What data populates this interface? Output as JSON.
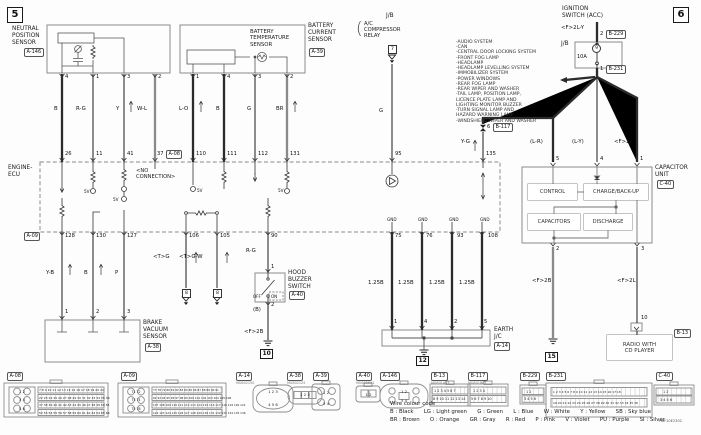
{
  "page": {
    "ref_left": "5",
    "ref_right": "6",
    "doc_code": "H8F10E230C"
  },
  "top": {
    "nps": {
      "name": "NEUTRAL\nPOSITION\nSENSOR",
      "conn": "A-146",
      "pins": [
        "4",
        "1",
        "3",
        "2"
      ],
      "wires": [
        "B",
        "R-G",
        "Y",
        "W-L"
      ]
    },
    "bcs": {
      "name": "BATTERY\nCURRENT\nSENSOR",
      "inner": "BATTERY\nTEMPERATURE\nSENSOR",
      "conn": "A-39",
      "pins": [
        "1",
        "4",
        "3",
        "2"
      ],
      "wires": [
        "L-O",
        "B",
        "G",
        "BR"
      ]
    },
    "relay": {
      "jb": "J/B",
      "brace": "(",
      "name": "A/C\nCOMPRESSOR\nRELAY",
      "ref": "7",
      "wire": "G"
    },
    "ign": {
      "name": "IGNITION\nSWITCH (ACC)",
      "wire": "<F>2L-Y",
      "pin2": "2",
      "conn2": "B-229",
      "jb": "J/B",
      "fuse": "9",
      "amp": "10A",
      "pin1": "1",
      "conn1": "B-231"
    },
    "systems": [
      "-AUDIO SYSTEM",
      "-CAN",
      "-CENTRAL DOOR LOCKING SYSTEM",
      "-FRONT FOG LAMP",
      "-HEADLAMP",
      "-HEADLAMP LEVELLING SYSTEM",
      "-IMMOBILIZER SYSTEM",
      "-POWER WINDOWS",
      "-REAR FOG LAMP",
      "-REAR WIPER AND WASHER",
      "-TAIL LAMP, POSITION LAMP,",
      "  LICENCE PLATE LAMP AND",
      "  LIGHTING MONITOR BUZZER",
      "-TURN SIGNAL LAMP AND",
      "  HAZARD WARNING LAMP",
      "-WINDSHIELD WIPER AND WASHER"
    ],
    "feed": {
      "yg": "Y-G",
      "pin6": "6",
      "conn": "B-117",
      "lr": "(L-R)",
      "ly": "(L-Y)",
      "f2l": "<F>2L"
    }
  },
  "ecu": {
    "name": "ENGINE-\nECU",
    "a08": "A-08",
    "a09": "A-09",
    "noconn": "<NO\nCONNECTION>",
    "v5": "5V",
    "gnd": "GND",
    "top_pins": [
      "26",
      "11",
      "41",
      "37",
      "110",
      "111",
      "112",
      "131",
      "95",
      "135"
    ],
    "bot_pins": [
      "128",
      "130",
      "127",
      "106",
      "105",
      "90",
      "75",
      "76",
      "93",
      "108"
    ]
  },
  "bottom": {
    "brake": {
      "wires": [
        "Y-B",
        "B",
        "P"
      ],
      "pins": [
        "1",
        "2",
        "3"
      ],
      "name": "BRAKE\nVACUUM\nSENSOR",
      "conn": "A-38"
    },
    "shield": {
      "wires": [
        "<T>G",
        "<T>G-W"
      ],
      "refs": [
        "8",
        "8"
      ]
    },
    "hood": {
      "wire": "R-G",
      "pin1": "1",
      "name": "HOOD\nBUZZER\nSWITCH",
      "conn": "A-40",
      "off": "OFF",
      "on": "ON",
      "pin2": "2",
      "wb": "(B)",
      "f2b": "<F>2B",
      "gnd_ref": "10"
    },
    "earth": {
      "wires": [
        "1.25B",
        "1.25B",
        "1.25B",
        "1.25B"
      ],
      "pins": [
        "1",
        "4",
        "2",
        "5"
      ],
      "name": "EARTH\nJ/C",
      "conn": "A-14",
      "gnd_ref": "12"
    },
    "cap": {
      "name": "CAPACITOR\nUNIT",
      "conn": "C-40",
      "blocks": [
        "CONTROL",
        "CHARGE/BACK-UP",
        "CAPACITORS",
        "DISCHARGE"
      ],
      "pin2": "2",
      "pin3": "3",
      "f2b": "<F>2B",
      "f2l": "<F>2L",
      "gnd_ref": "15",
      "radio_pin": "10"
    },
    "radio": {
      "name": "RADIO WITH\nCD PLAYER",
      "conn": "B-13"
    }
  },
  "connectors": {
    "a08": {
      "id": "A-08",
      "circles": "1 2\n3 4\n5 6",
      "rows": [
        "7 8 9 10 11 12 13 14 15 16 17 18 19 20 21",
        "22 23 24 25 26 27 28 29 30 31 32 33 34 35 36",
        "37 38 39 40 41 42 43 44 45 46 47 48 49 50 51",
        "52 53 54 55 56 57 58 59 60 61 62 63 64 65 66"
      ]
    },
    "a09": {
      "id": "A-09",
      "circles": "71 72\n73 74\n75 76",
      "rows": [
        "77 78 79 80 81 82 83 84 85 86 87 88 89 90 91",
        "92 93 94 95 96 97 98 99 100 101 102 103 104 105 106",
        "107 108 109 110 111 112 113 114 115 116 117 118 119 120 121",
        "122 123 124 125 126 127 128 129 130 131 132 133 134 135 136"
      ]
    },
    "a14": {
      "id": "A-14",
      "code": "MU802150",
      "pins": "1 2 3\n4 5 6"
    },
    "a38": {
      "id": "A-38",
      "code": "MU802125",
      "pins": "1 2 3"
    },
    "a39": {
      "id": "A-39",
      "pins": "1 2\n3 4"
    },
    "a40": {
      "id": "A-40",
      "code": "MU802501",
      "pins": "1 2"
    },
    "a146": {
      "id": "A-146",
      "pins": "1  2\n3  4"
    },
    "b13": {
      "id": "B-13",
      "code": "MU801453",
      "rows": [
        "1 2 3 4 5 6 7",
        "8 9 10 11 12 13 14"
      ]
    },
    "b117": {
      "id": "B-117",
      "code": "MU801867",
      "rows": [
        "1 2  3 4",
        "5 6 7 8 9 10"
      ]
    },
    "b229": {
      "id": "B-229",
      "rows": [
        "1  2",
        "3 4 5 6"
      ]
    },
    "b231": {
      "id": "B-231",
      "rows": [
        "1 2 3 4 5 6 7 8 9 10 11 12 13 14 15 16 17 18",
        "19 20 21 22 23 24 25 26 27 28 29 30 31 32 33 34 35 36"
      ]
    },
    "c40": {
      "id": "C-40",
      "rows": [
        "1  2",
        "3 4 5 6"
      ]
    }
  },
  "legend": {
    "title": "Wire colour code",
    "line1": "B : Black      LG : Light green      G : Green      L : Blue      W : White      Y : Yellow      SB : Sky blue",
    "line2": "BR : Brown      O : Orange      GR : Gray      R : Red      P : Pink      V : Violet      PU : Purple      SI : Silver"
  }
}
